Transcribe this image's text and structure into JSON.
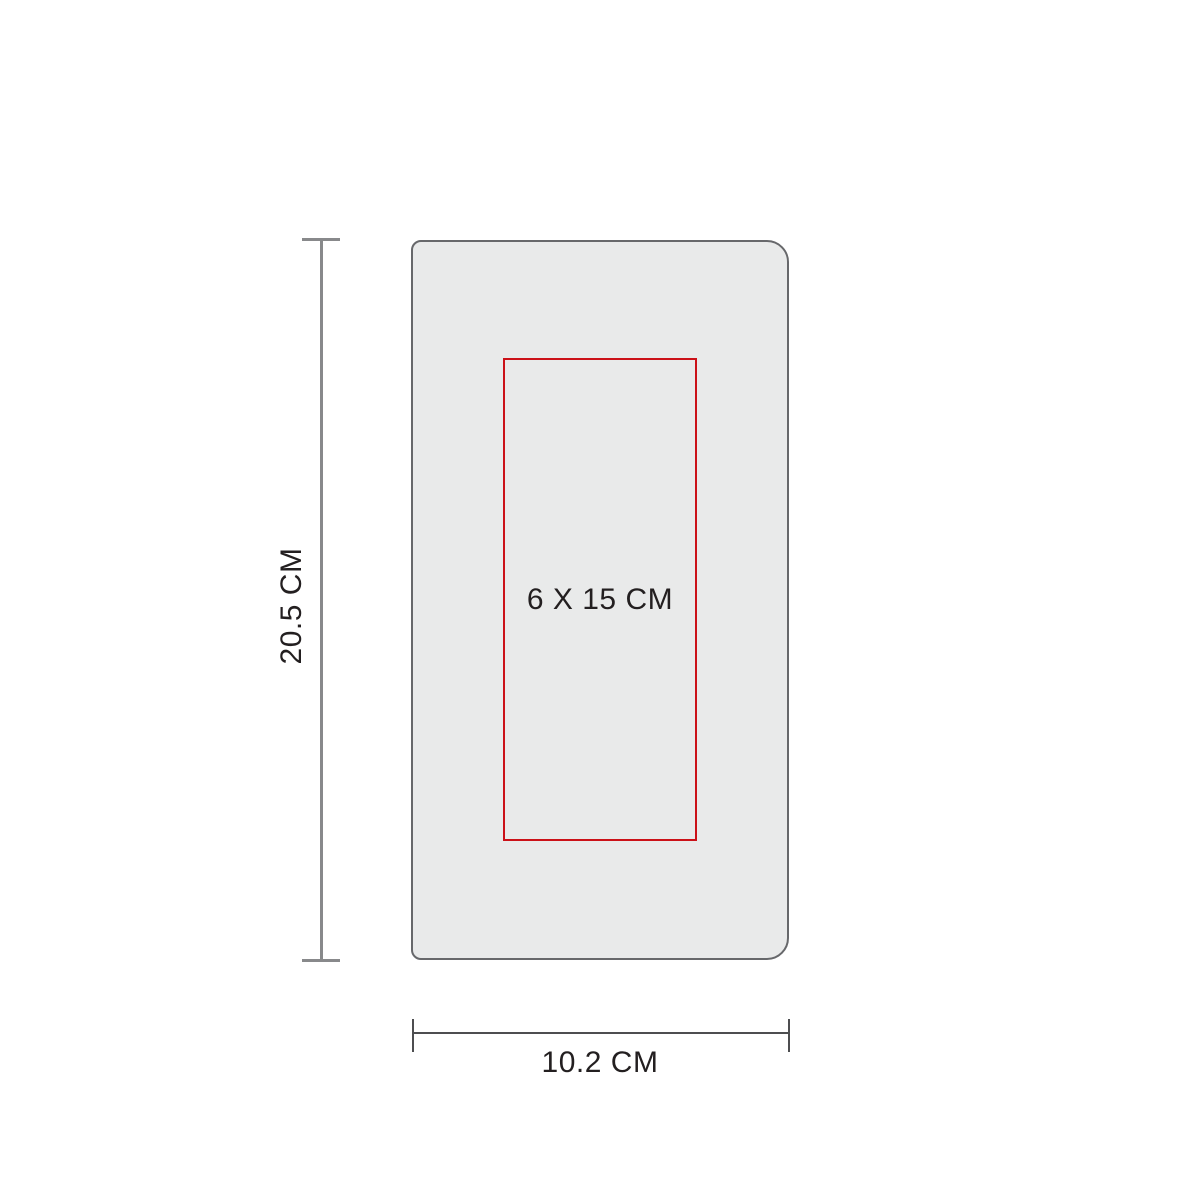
{
  "diagram": {
    "background": "#ffffff",
    "text_color": "#231f20",
    "product": {
      "fill": "#e9eaea",
      "stroke": "#67686b"
    },
    "print_area": {
      "label": "6 X 15 CM",
      "stroke": "#cb1118"
    },
    "height_dimension": {
      "label": "20.5 CM",
      "line_color": "#88898b"
    },
    "width_dimension": {
      "label": "10.2 CM",
      "line_color": "#4d4e50"
    }
  }
}
